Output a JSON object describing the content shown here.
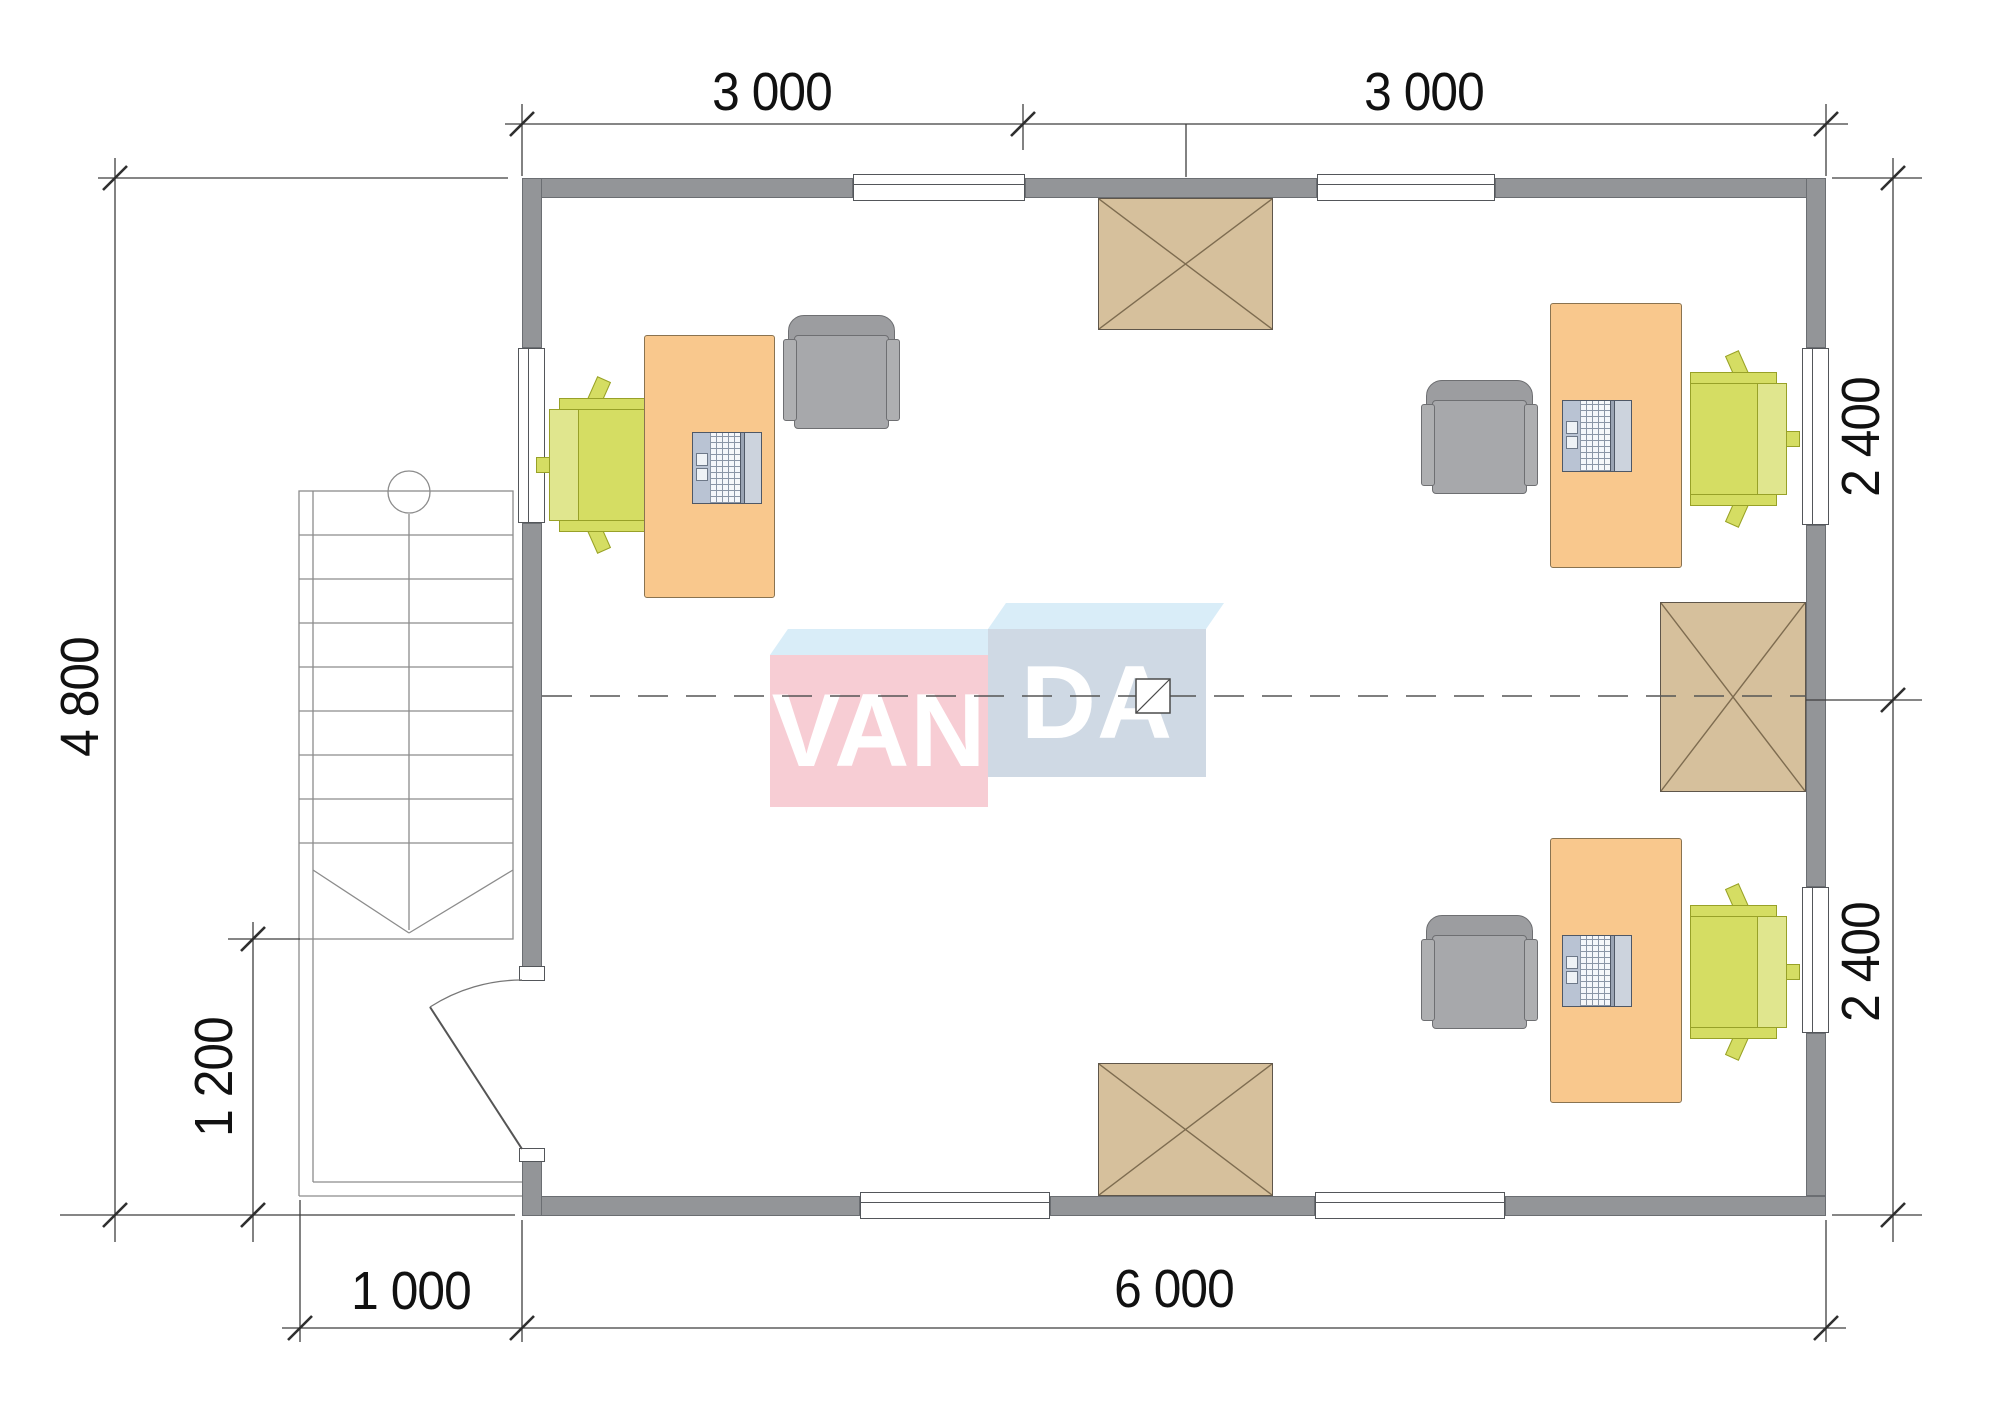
{
  "plan": {
    "dimensions": {
      "top_bay_left": "3 000",
      "top_bay_right": "3 000",
      "right_upper": "2 400",
      "right_lower": "2 400",
      "left_total": "4 800",
      "porch_depth": "1 200",
      "porch_width": "1 000",
      "bottom_total": "6 000"
    },
    "logo": {
      "left": "VAN",
      "right": "DA"
    },
    "colors": {
      "wall": "#939598",
      "desk": "#f9c88d",
      "chair_green": "#d5dd63",
      "chair_gray": "#a7a8ab",
      "skylight": "#d6c09c",
      "logo_pink": "#f7cdd4",
      "logo_blue_gray": "#cfd9e4",
      "logo_cyan": "#d9edf8",
      "dimension_text": "#111111"
    }
  }
}
